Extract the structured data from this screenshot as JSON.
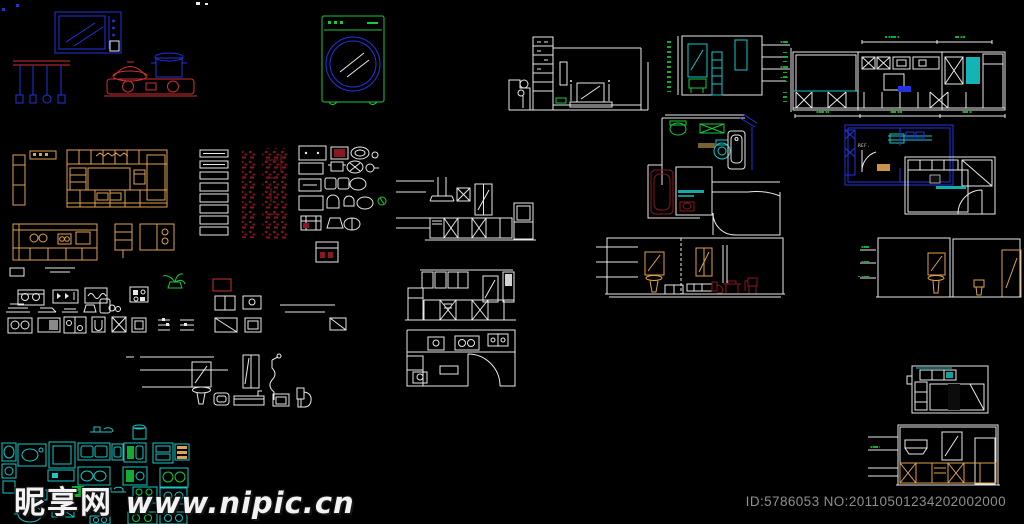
{
  "canvas": {
    "width": 1024,
    "height": 524,
    "background": "#000000"
  },
  "watermark": {
    "site_name": "昵享网",
    "site_url": "www.nipic.cn",
    "color": "#f2f2f2"
  },
  "footer": {
    "id_text": "ID:5786053 NO:20110501234202002000",
    "color": "#8f8f8f"
  },
  "labels": {
    "fridge": "REF."
  },
  "colors": {
    "blue": "#2433e0",
    "red": "#cf3030",
    "dark_red": "#8a1820",
    "green": "#17c93c",
    "cyan": "#16c8c8",
    "orange": "#e0a24e",
    "white": "#e9e9e9",
    "tile_line": "#b9b9b9",
    "watermark_white": "#f2f2f2",
    "id_gray": "#8f8f8f"
  },
  "block_inventory": [
    "microwave-block",
    "pot-rack-block",
    "gas-stove-block",
    "washing-machine-block",
    "living-room-tv-wall-elevation",
    "bathroom-mirror-wall-elevation",
    "kitchen-long-elevation",
    "kitchen-orange-elevation",
    "kitchen-orange-plan",
    "material-legend-swatches",
    "red-text-annotations",
    "sink-cooktop-blocks",
    "kitchen-elevation-hood",
    "kitchen-elevation-2",
    "kitchen-plan-white",
    "appliance-blocks-rows",
    "bathroom-fixture-blocks",
    "bathroom-plan",
    "kitchen-plan-blue",
    "kitchen-plan-tiled",
    "bath-tile-elevation-1",
    "bath-tile-elevation-2",
    "kitchen-plan-small",
    "kitchen-elevation-tiled",
    "sink-cooktop-panel"
  ]
}
